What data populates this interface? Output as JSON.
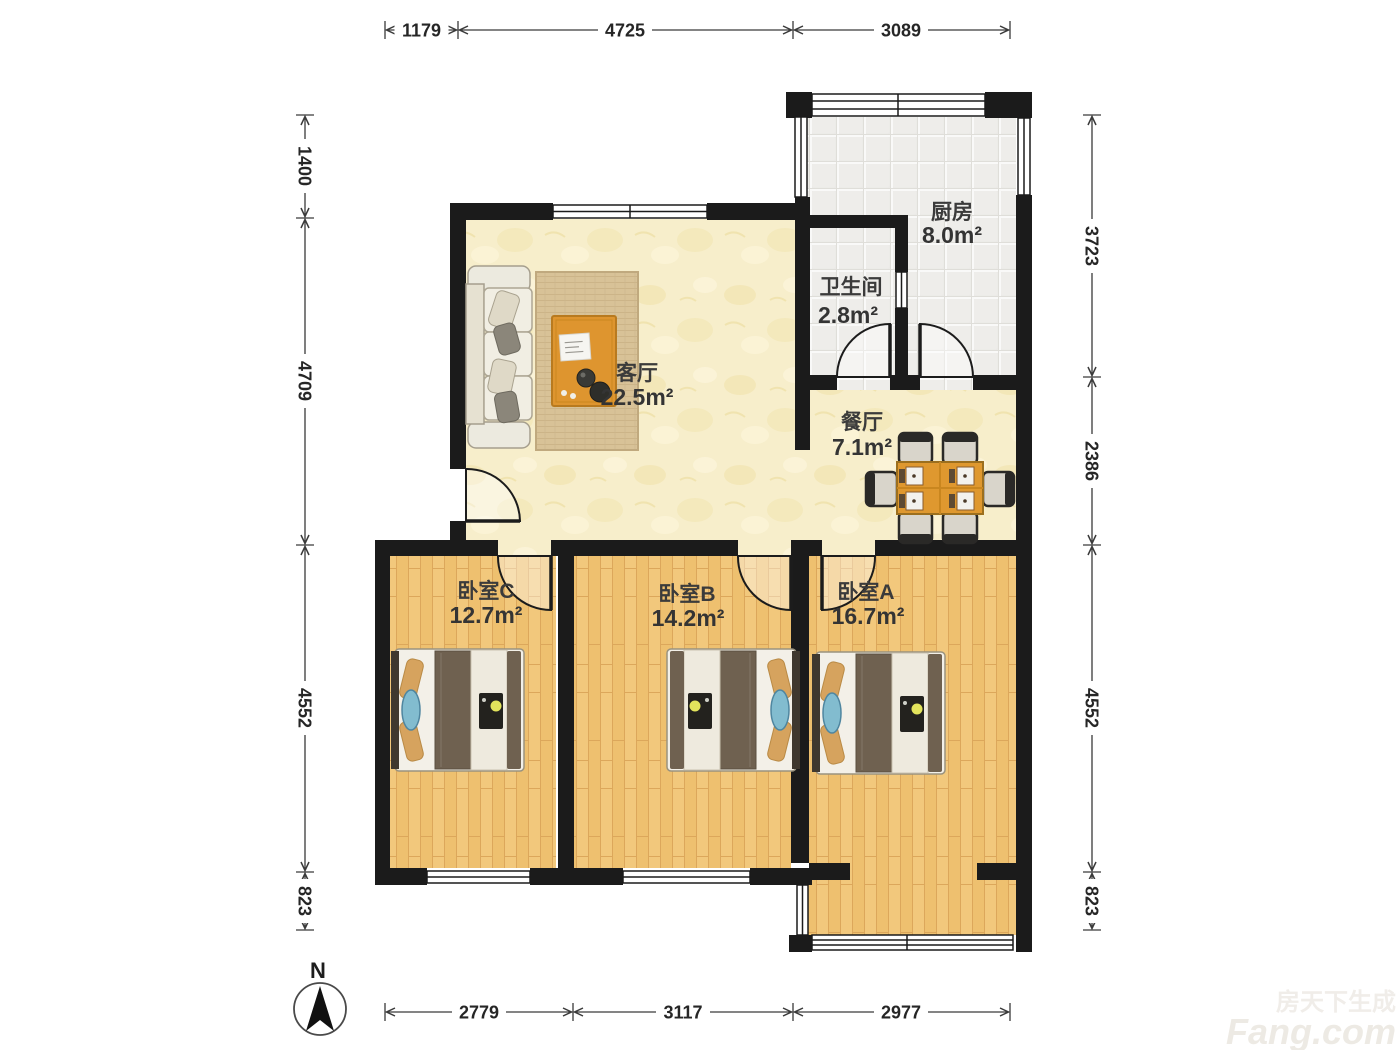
{
  "rooms": {
    "kitchen": {
      "name": "厨房",
      "area": "8.0m²"
    },
    "bathroom": {
      "name": "卫生间",
      "area": "2.8m²"
    },
    "living": {
      "name": "客厅",
      "area": "22.5m²"
    },
    "dining": {
      "name": "餐厅",
      "area": "7.1m²"
    },
    "bedroom_c": {
      "name": "卧室C",
      "area": "12.7m²"
    },
    "bedroom_b": {
      "name": "卧室B",
      "area": "14.2m²"
    },
    "bedroom_a": {
      "name": "卧室A",
      "area": "16.7m²"
    }
  },
  "dimensions": {
    "top": [
      "1179",
      "4725",
      "3089"
    ],
    "bottom": [
      "2779",
      "3117",
      "2977"
    ],
    "left": [
      "1400",
      "4709",
      "4552",
      "823"
    ],
    "right": [
      "3723",
      "2386",
      "4552",
      "823"
    ]
  },
  "compass": {
    "label": "N"
  },
  "watermark": {
    "line1": "房天下生成",
    "line2": "Fang.com"
  },
  "colors": {
    "wall": "#1b1b1b",
    "wood_floor": "#f2c87c",
    "tile_floor": "#ebeae7",
    "cream_floor": "#f7eecb",
    "table_wood": "#df982f",
    "dimension_ink": "#3a3a3a"
  }
}
